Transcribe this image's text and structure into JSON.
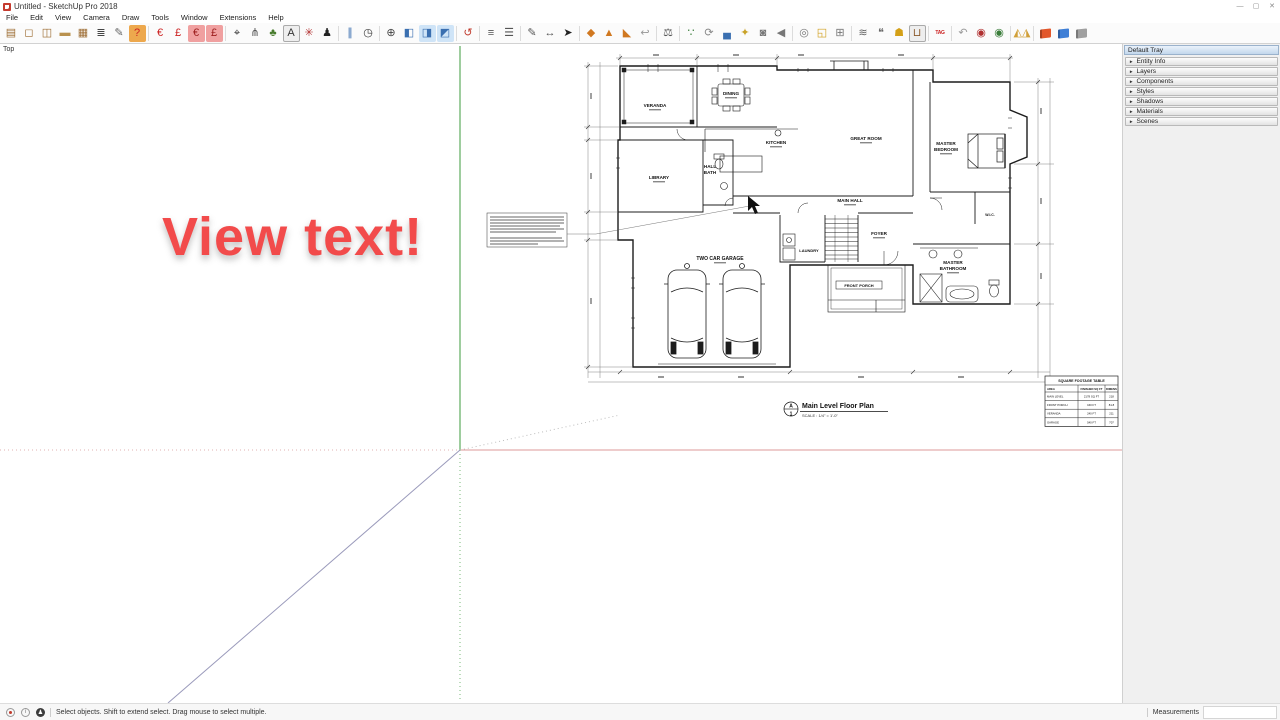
{
  "window": {
    "title": "Untitled - SketchUp Pro 2018",
    "controls": {
      "minimize": "—",
      "maximize": "▢",
      "close": "✕"
    }
  },
  "menu": {
    "items": [
      "File",
      "Edit",
      "View",
      "Camera",
      "Draw",
      "Tools",
      "Window",
      "Extensions",
      "Help"
    ]
  },
  "toolbar": {
    "groups": [
      [
        {
          "name": "cabinet",
          "glyph": "▤",
          "color": "#9c6b31"
        },
        {
          "name": "door",
          "glyph": "◻",
          "color": "#9c6b31"
        },
        {
          "name": "window-frame",
          "glyph": "◫",
          "color": "#9c6b31"
        },
        {
          "name": "board",
          "glyph": "▬",
          "color": "#b9914e"
        },
        {
          "name": "grille",
          "glyph": "▦",
          "color": "#9c6b31"
        },
        {
          "name": "report-list",
          "glyph": "≣",
          "color": "#444444"
        },
        {
          "name": "eyedropper",
          "glyph": "✎",
          "color": "#666666"
        },
        {
          "name": "help-door",
          "glyph": "?",
          "color": "#cc2222",
          "bg": "#eda84d"
        }
      ],
      [
        {
          "name": "estimate-euro-a",
          "glyph": "€",
          "color": "#cc2222"
        },
        {
          "name": "estimate-pound-a",
          "glyph": "£",
          "color": "#cc2222"
        },
        {
          "name": "estimate-euro-b",
          "glyph": "€",
          "color": "#9c1d1d",
          "bg": "#f0a0a0"
        },
        {
          "name": "estimate-pound-b",
          "glyph": "£",
          "color": "#9c1d1d",
          "bg": "#f0a0a0"
        }
      ],
      [
        {
          "name": "probe",
          "glyph": "⌖",
          "color": "#333333"
        },
        {
          "name": "pliers",
          "glyph": "⋔",
          "color": "#555555"
        },
        {
          "name": "leaf",
          "glyph": "♣",
          "color": "#4a7d2f"
        },
        {
          "name": "label-box",
          "glyph": "A",
          "color": "#333333",
          "boxed": true
        },
        {
          "name": "axes-tool",
          "glyph": "✳",
          "color": "#b33333"
        },
        {
          "name": "sculpture",
          "glyph": "♟",
          "color": "#222222"
        }
      ],
      [
        {
          "name": "section-planes",
          "glyph": "∥",
          "color": "#3a6fb0"
        },
        {
          "name": "clock",
          "glyph": "◷",
          "color": "#333333"
        }
      ],
      [
        {
          "name": "compass",
          "glyph": "⊕",
          "color": "#444444"
        },
        {
          "name": "orbit-cube",
          "glyph": "◧",
          "color": "#3a6fb0"
        },
        {
          "name": "pan-cube",
          "glyph": "◨",
          "color": "#3a6fb0",
          "bg": "#cfe4f7"
        },
        {
          "name": "zoom-cube",
          "glyph": "◩",
          "color": "#3a6fb0",
          "bg": "#cfe4f7"
        }
      ],
      [
        {
          "name": "rotate-red",
          "glyph": "↺",
          "color": "#c0392b"
        }
      ],
      [
        {
          "name": "line-spacing-a",
          "glyph": "≡",
          "color": "#555555"
        },
        {
          "name": "line-spacing-b",
          "glyph": "☰",
          "color": "#555555"
        }
      ],
      [
        {
          "name": "pencil",
          "glyph": "✎",
          "color": "#555555"
        },
        {
          "name": "dimension-tool",
          "glyph": "↔",
          "color": "#555555"
        },
        {
          "name": "select-arrow",
          "glyph": "➤",
          "color": "#222222"
        }
      ],
      [
        {
          "name": "sandbox-from-contours",
          "glyph": "◆",
          "color": "#d07820"
        },
        {
          "name": "sandbox-from-scratch",
          "glyph": "▲",
          "color": "#d07820"
        },
        {
          "name": "sandbox-smoove",
          "glyph": "◣",
          "color": "#d07820"
        },
        {
          "name": "sandbox-back",
          "glyph": "↩",
          "color": "#999999"
        }
      ],
      [
        {
          "name": "scale-balance",
          "glyph": "⚖",
          "color": "#555555"
        }
      ],
      [
        {
          "name": "walk",
          "glyph": "∵",
          "color": "#3a7d3a"
        },
        {
          "name": "sync",
          "glyph": "⟳",
          "color": "#888888"
        },
        {
          "name": "car",
          "glyph": "▄",
          "color": "#3a6fb0"
        },
        {
          "name": "key",
          "glyph": "✦",
          "color": "#c9a227"
        },
        {
          "name": "camera",
          "glyph": "◙",
          "color": "#777777"
        },
        {
          "name": "speaker",
          "glyph": "◀",
          "color": "#777777"
        }
      ],
      [
        {
          "name": "film-reel",
          "glyph": "◎",
          "color": "#777777"
        },
        {
          "name": "parts-box",
          "glyph": "◱",
          "color": "#d0a020"
        },
        {
          "name": "grid-box",
          "glyph": "⊞",
          "color": "#777777"
        }
      ],
      [
        {
          "name": "sliders",
          "glyph": "≋",
          "color": "#666666"
        },
        {
          "name": "comment-bubble",
          "glyph": "❝",
          "color": "#666666"
        },
        {
          "name": "shield",
          "glyph": "☗",
          "color": "#d4a017"
        },
        {
          "name": "cart",
          "glyph": "⊔",
          "color": "#8b5a2b",
          "boxed": true
        }
      ],
      [
        {
          "name": "tag",
          "glyph": "TAG",
          "color": "#cc2222",
          "cls": "text"
        }
      ],
      [
        {
          "name": "undo-gray",
          "glyph": "↶",
          "color": "#999999"
        },
        {
          "name": "stamp-red",
          "glyph": "◉",
          "color": "#b03030"
        },
        {
          "name": "stamp-green",
          "glyph": "◉",
          "color": "#3a7d3a"
        }
      ],
      [
        {
          "name": "mirror-flip",
          "glyph": "◭◮",
          "color": "#d1a03a"
        }
      ],
      [
        {
          "name": "book-red",
          "shape": "book",
          "color": "#e2572b"
        },
        {
          "name": "book-blue",
          "shape": "book",
          "color": "#3f7fd6"
        },
        {
          "name": "book-gray",
          "shape": "book",
          "color": "#a0a0a0"
        }
      ]
    ]
  },
  "viewport": {
    "view_label": "Top"
  },
  "overlay": {
    "text": "View text!",
    "color": "#f24b4b"
  },
  "plan": {
    "labels": {
      "veranda": "VERANDA",
      "dining": "DINING",
      "kitchen": "KITCHEN",
      "great_room": "GREAT ROOM",
      "library": "LIBRARY",
      "hall_bath_1": "HALL",
      "hall_bath_2": "BATH",
      "main_hall": "MAIN HALL",
      "master_bedroom_1": "MASTER",
      "master_bedroom_2": "BEDROOM",
      "wic": "W.I.C.",
      "laundry": "LAUNDRY",
      "foyer": "FOYER",
      "garage": "TWO CAR GARAGE",
      "front_porch": "FRONT PORCH",
      "master_bath_1": "MASTER",
      "master_bath_2": "BATHROOM"
    },
    "title_block": {
      "mark_letter": "A",
      "mark_number": "1",
      "title": "Main Level Floor Plan",
      "scale": "SCALE : 1/4\" = 1'-0\""
    },
    "sqft_table": {
      "title": "SQUARE FOOTAGE TABLE",
      "headers": [
        "AREA",
        "FINISHED SQ FT",
        "DIMENS"
      ],
      "rows": [
        [
          "MAIN LEVEL",
          "2178 SQ FT",
          "218"
        ],
        [
          "FRONT PORCH",
          "160 FT",
          "81.8"
        ],
        [
          "VERANDA",
          "240 FT",
          "211"
        ],
        [
          "GARAGE",
          "540 FT",
          "707"
        ]
      ]
    }
  },
  "tray": {
    "title": "Default Tray",
    "sections": [
      "Entity Info",
      "Layers",
      "Components",
      "Styles",
      "Shadows",
      "Materials",
      "Scenes"
    ]
  },
  "statusbar": {
    "hint": "Select objects. Shift to extend select. Drag mouse to select multiple.",
    "measurements_label": "Measurements",
    "measurements_value": ""
  }
}
